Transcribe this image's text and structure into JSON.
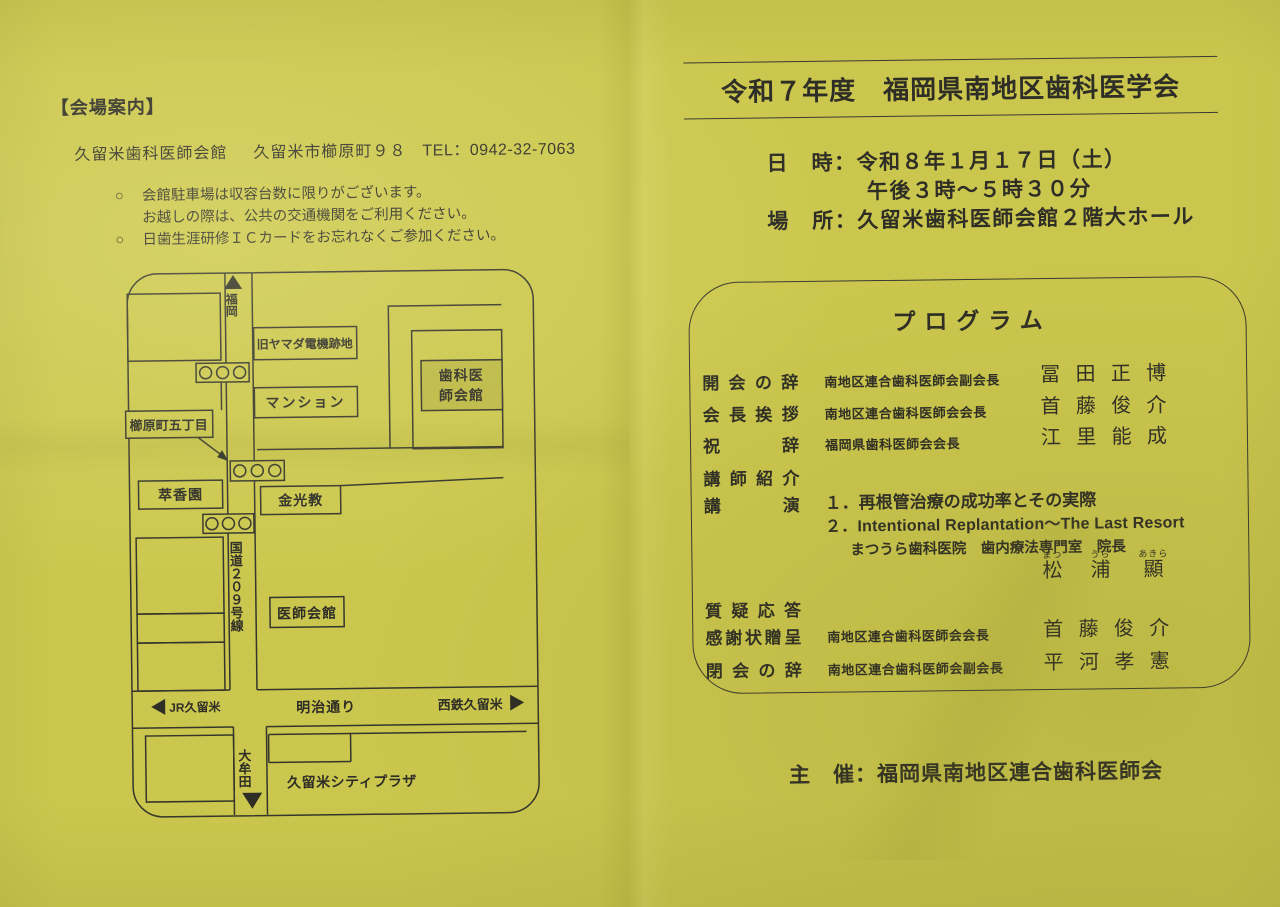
{
  "paper": {
    "bg": "#cbc74e",
    "ink": "#2e2d26",
    "line": "#35352c",
    "shaded_box": "#bcb845"
  },
  "left_page": {
    "heading": "【会場案内】",
    "venue": {
      "name": "久留米歯科医師会館",
      "address": "久留米市櫛原町９８",
      "tel": "TEL：0942-32-7063"
    },
    "notes": [
      {
        "bullet": "○",
        "text": "会館駐車場は収容台数に限りがございます。"
      },
      {
        "bullet": "",
        "text": "お越しの際は、公共の交通機関をご利用ください。"
      },
      {
        "bullet": "○",
        "text": "日歯生涯研修ＩＣカードをお忘れなくご参加ください。"
      }
    ],
    "map": {
      "north": "福岡",
      "south": "大牟田",
      "west": "JR久留米",
      "east": "西鉄久留米",
      "route": "国道２０９号線",
      "street": "明治通り",
      "b_yamada": "旧ヤマダ電機跡地",
      "b_mansion": "マンション",
      "b_dental1": "歯科医",
      "b_dental2": "師会館",
      "b_kushihara": "櫛原町五丁目",
      "b_suikoen": "萃香園",
      "b_konko": "金光教",
      "b_ishikaikan": "医師会館",
      "b_cityplaza": "久留米シティプラザ"
    }
  },
  "right_page": {
    "title": "令和７年度　福岡県南地区歯科医学会",
    "datetime_label": "日　時：",
    "datetime": "令和８年１月１７日（土）",
    "datetime2": "午後３時～５時３０分",
    "place_label": "場　所：",
    "place": "久留米歯科医師会館２階大ホール",
    "program": {
      "title": "プログラム",
      "rows": [
        {
          "label": "開会の辞",
          "role": "南地区連合歯科医師会副会長",
          "name": "冨田正博"
        },
        {
          "label": "会長挨拶",
          "role": "南地区連合歯科医師会会長",
          "name": "首藤俊介"
        },
        {
          "label": "祝辞",
          "role": "福岡県歯科医師会会長",
          "name": "江里能成"
        },
        {
          "label": "講師紹介"
        },
        {
          "label": "講演"
        },
        {
          "label": "質疑応答"
        },
        {
          "label": "感謝状贈呈",
          "role": "南地区連合歯科医師会会長",
          "name": "首藤俊介"
        },
        {
          "label": "閉会の辞",
          "role": "南地区連合歯科医師会副会長",
          "name": "平河孝憲"
        }
      ],
      "lectures": [
        {
          "no": "１．",
          "title": "再根管治療の成功率とその実際"
        },
        {
          "no": "２．",
          "title": "Intentional Replantation～The Last Resort"
        }
      ],
      "speaker": {
        "affiliation": "まつうら歯科医院　歯内療法専門室　院長",
        "name": [
          {
            "furigana": "まつ",
            "kanji": "松"
          },
          {
            "furigana": "うら",
            "kanji": "浦"
          },
          {
            "furigana": "あきら",
            "kanji": "顯"
          }
        ]
      }
    },
    "organizer_label": "主　催：",
    "organizer": "福岡県南地区連合歯科医師会"
  }
}
